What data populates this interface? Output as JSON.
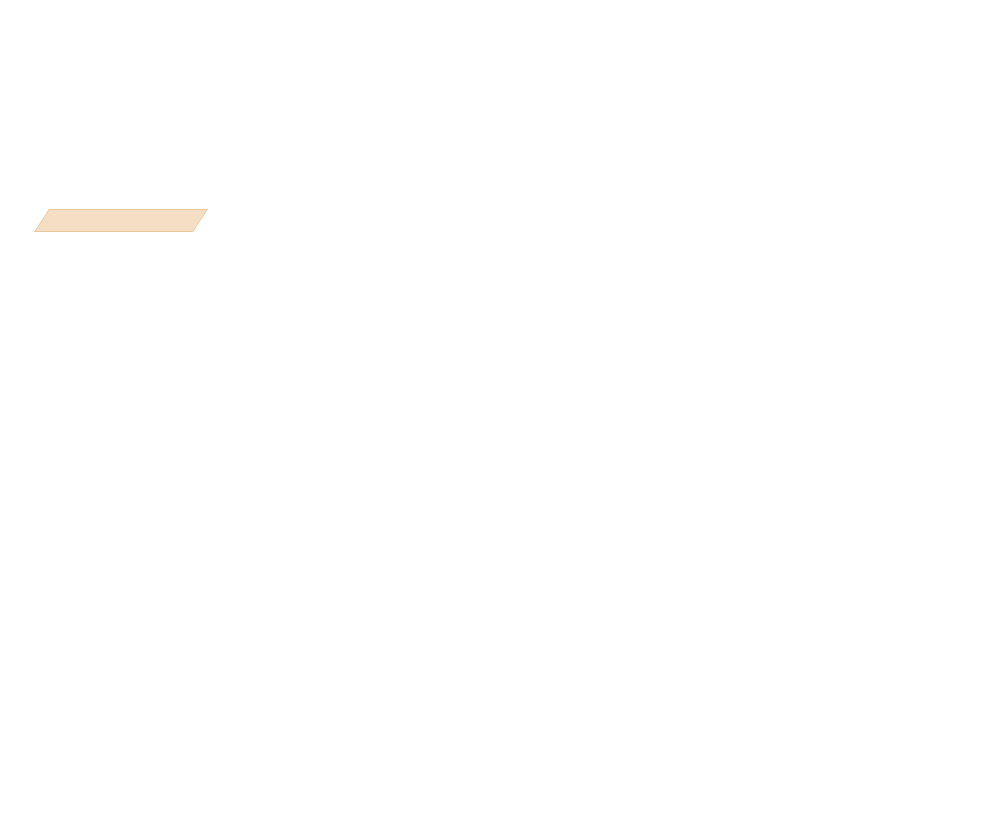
{
  "header": {
    "columns": [
      {
        "lines": [
          {
            "label": "",
            "value": "Peru Creek"
          },
          {
            "label": "",
            "value": "Vail/Summit County"
          },
          {
            "label": "",
            "value": "CO"
          },
          {
            "label": "Elevation:",
            "value": "12000 ft"
          },
          {
            "label": "Aspect:",
            "value": "N"
          },
          {
            "label": "Specifics:",
            "value": ""
          }
        ]
      },
      {
        "lines": [
          {
            "label": "",
            "value": "Kreston Rohrig"
          },
          {
            "label": "",
            "value": "01/02/2018 - 1:00pm"
          },
          {
            "label": "Co-ord:",
            "value": "39.58885N, -105.85443W"
          },
          {
            "label": "Slope Angle:",
            "value": "32°"
          },
          {
            "label": "Wind Loading:",
            "value": ""
          }
        ]
      },
      {
        "lines": [
          {
            "label": "Stability:",
            "value": ""
          },
          {
            "label": "Air Temperature:",
            "value": ""
          },
          {
            "label": "Sky Cover:",
            "value": "FEW"
          },
          {
            "label": "Precipitation:",
            "value": "NO"
          },
          {
            "label": "Wind:",
            "value": "Calm"
          }
        ]
      }
    ],
    "hs": {
      "label": "HS:",
      "value": "60"
    },
    "layer_notes": {
      "title": "Layer Notes:",
      "note": {
        "label": "43-26cm:",
        "value": "Problematic layer"
      }
    }
  },
  "logo": {
    "text": "SNOW PILOT",
    "banner_fill": "#f5dfc4",
    "banner_border": "#e9c9a2",
    "snowflake_color": "#bdcad5"
  },
  "table": {
    "headers": {
      "form": "Form",
      "crystal": "Crystal",
      "size": "Size",
      "moisture": "Moisture",
      "rho": "ρ",
      "rho_units": "kg/m³",
      "stability": "Stability tests & Layer comments"
    }
  },
  "notes_label": "Notes:",
  "chart_data": {
    "type": "bar",
    "title": "Snow pit hardness profile",
    "orientation": "horizontal",
    "ylabel": "Depth (cm)",
    "xlabel": "Hand hardness",
    "depth_axis": {
      "min": 0,
      "max": 62,
      "minor_step": 5,
      "labels": [
        {
          "cm": 60,
          "text": "60"
        },
        {
          "cm": 50,
          "text": "50"
        },
        {
          "cm": 40,
          "text": "40"
        },
        {
          "cm": 30,
          "text": "30"
        },
        {
          "cm": 20,
          "text": "20"
        },
        {
          "cm": 10,
          "text": "10"
        },
        {
          "cm": 0,
          "text": "0"
        }
      ]
    },
    "hardness_axis": {
      "labels": [
        {
          "text": "I",
          "f": 0.1028
        },
        {
          "text": "K",
          "f": 0.2206
        },
        {
          "text": "P",
          "f": 0.5549
        },
        {
          "text": "1F",
          "f": 0.7783
        },
        {
          "text": "4F",
          "f": 0.8926
        },
        {
          "text": "F",
          "f": 0.97
        }
      ],
      "minor_f": [
        0.154,
        0.1871,
        0.3118,
        0.4873,
        0.6236,
        0.7236,
        0.8391,
        0.8622,
        0.9138,
        0.9522,
        0.9854
      ]
    },
    "layers": [
      {
        "top_cm": 60,
        "bottom_cm": 55,
        "hardness": "P",
        "f": 0.5549
      },
      {
        "top_cm": 55,
        "bottom_cm": 43,
        "hardness": "4F-",
        "f": 0.9138
      },
      {
        "top_cm": 43,
        "bottom_cm": 26,
        "hardness": "F",
        "f": 0.97
      },
      {
        "top_cm": 26,
        "bottom_cm": 24,
        "hardness": "1F",
        "f": 0.7783
      },
      {
        "top_cm": 24,
        "bottom_cm": 0,
        "hardness": "4F",
        "f": 0.8875
      }
    ],
    "failure_line": {
      "depth_cm": 43,
      "f_from": 0.962,
      "color": "#cc2020"
    },
    "grains": [
      {
        "depth_cm": 57.5,
        "form": "DF",
        "glyph": "slashed-dot",
        "glyph_char": "",
        "size_mm": ""
      },
      {
        "depth_cm": 49,
        "form": "RG",
        "glyph": "dot",
        "glyph_char": "",
        "size_mm": ""
      },
      {
        "depth_cm": 34.5,
        "form": "FC",
        "glyph": "caret",
        "glyph_char": "∧",
        "size_mm": "3"
      },
      {
        "depth_cm": 25,
        "form": "MF",
        "glyph": "double-circles",
        "glyph_char": "",
        "size_mm": ""
      },
      {
        "depth_cm": 12,
        "form": "FC",
        "glyph": "caret",
        "glyph_char": "∧",
        "size_mm": "5"
      }
    ],
    "annotation": {
      "depth_cm": 43,
      "text": "2x ECTP3 @43cm"
    },
    "layer_line_depths": [
      60,
      55,
      43,
      26,
      24
    ],
    "bar_fill": "#9f9fd9",
    "bar_stroke": "#3333bb",
    "axis_color": "#000000"
  }
}
